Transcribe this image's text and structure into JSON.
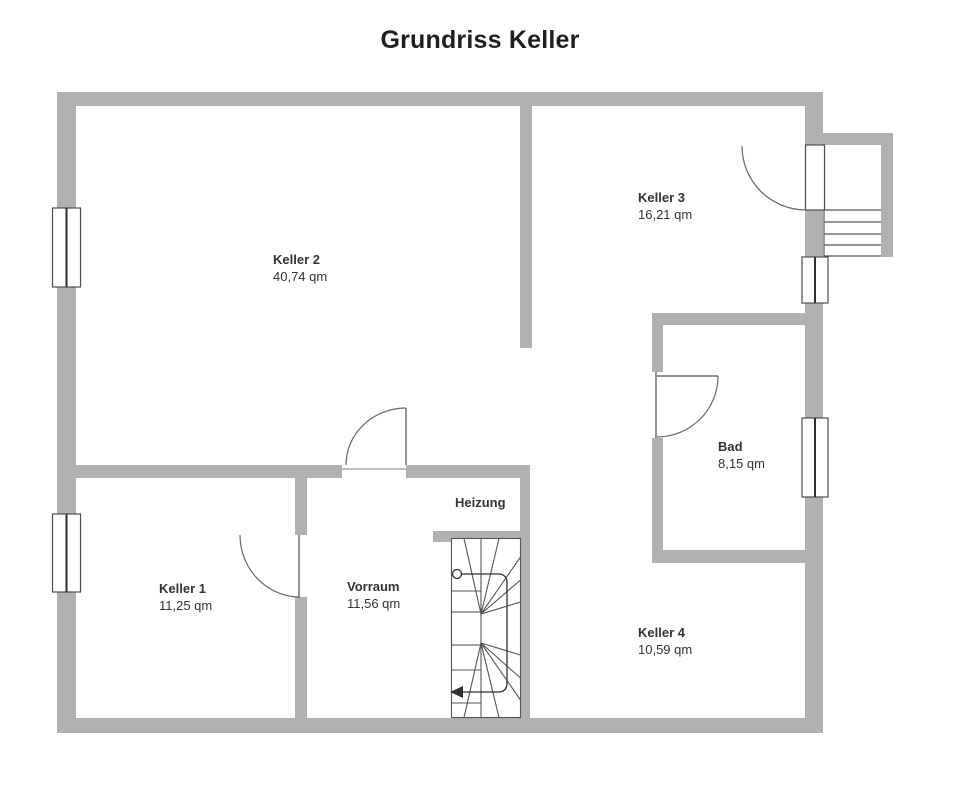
{
  "title": "Grundriss Keller",
  "rooms": {
    "keller2": {
      "name": "Keller 2",
      "area": "40,74 qm"
    },
    "keller3": {
      "name": "Keller 3",
      "area": "16,21 qm"
    },
    "bad": {
      "name": "Bad",
      "area": "8,15 qm"
    },
    "keller1": {
      "name": "Keller 1",
      "area": "11,25 qm"
    },
    "vorraum": {
      "name": "Vorraum",
      "area": "11,56 qm"
    },
    "heizung": {
      "name": "Heizung"
    },
    "keller4": {
      "name": "Keller 4",
      "area": "10,59 qm"
    }
  },
  "colors": {
    "wall": "#b1b1b1",
    "line": "#4d4d4d",
    "arc": "#666666",
    "text": "#333333",
    "title": "#1f1f1f",
    "bg": "#ffffff"
  }
}
